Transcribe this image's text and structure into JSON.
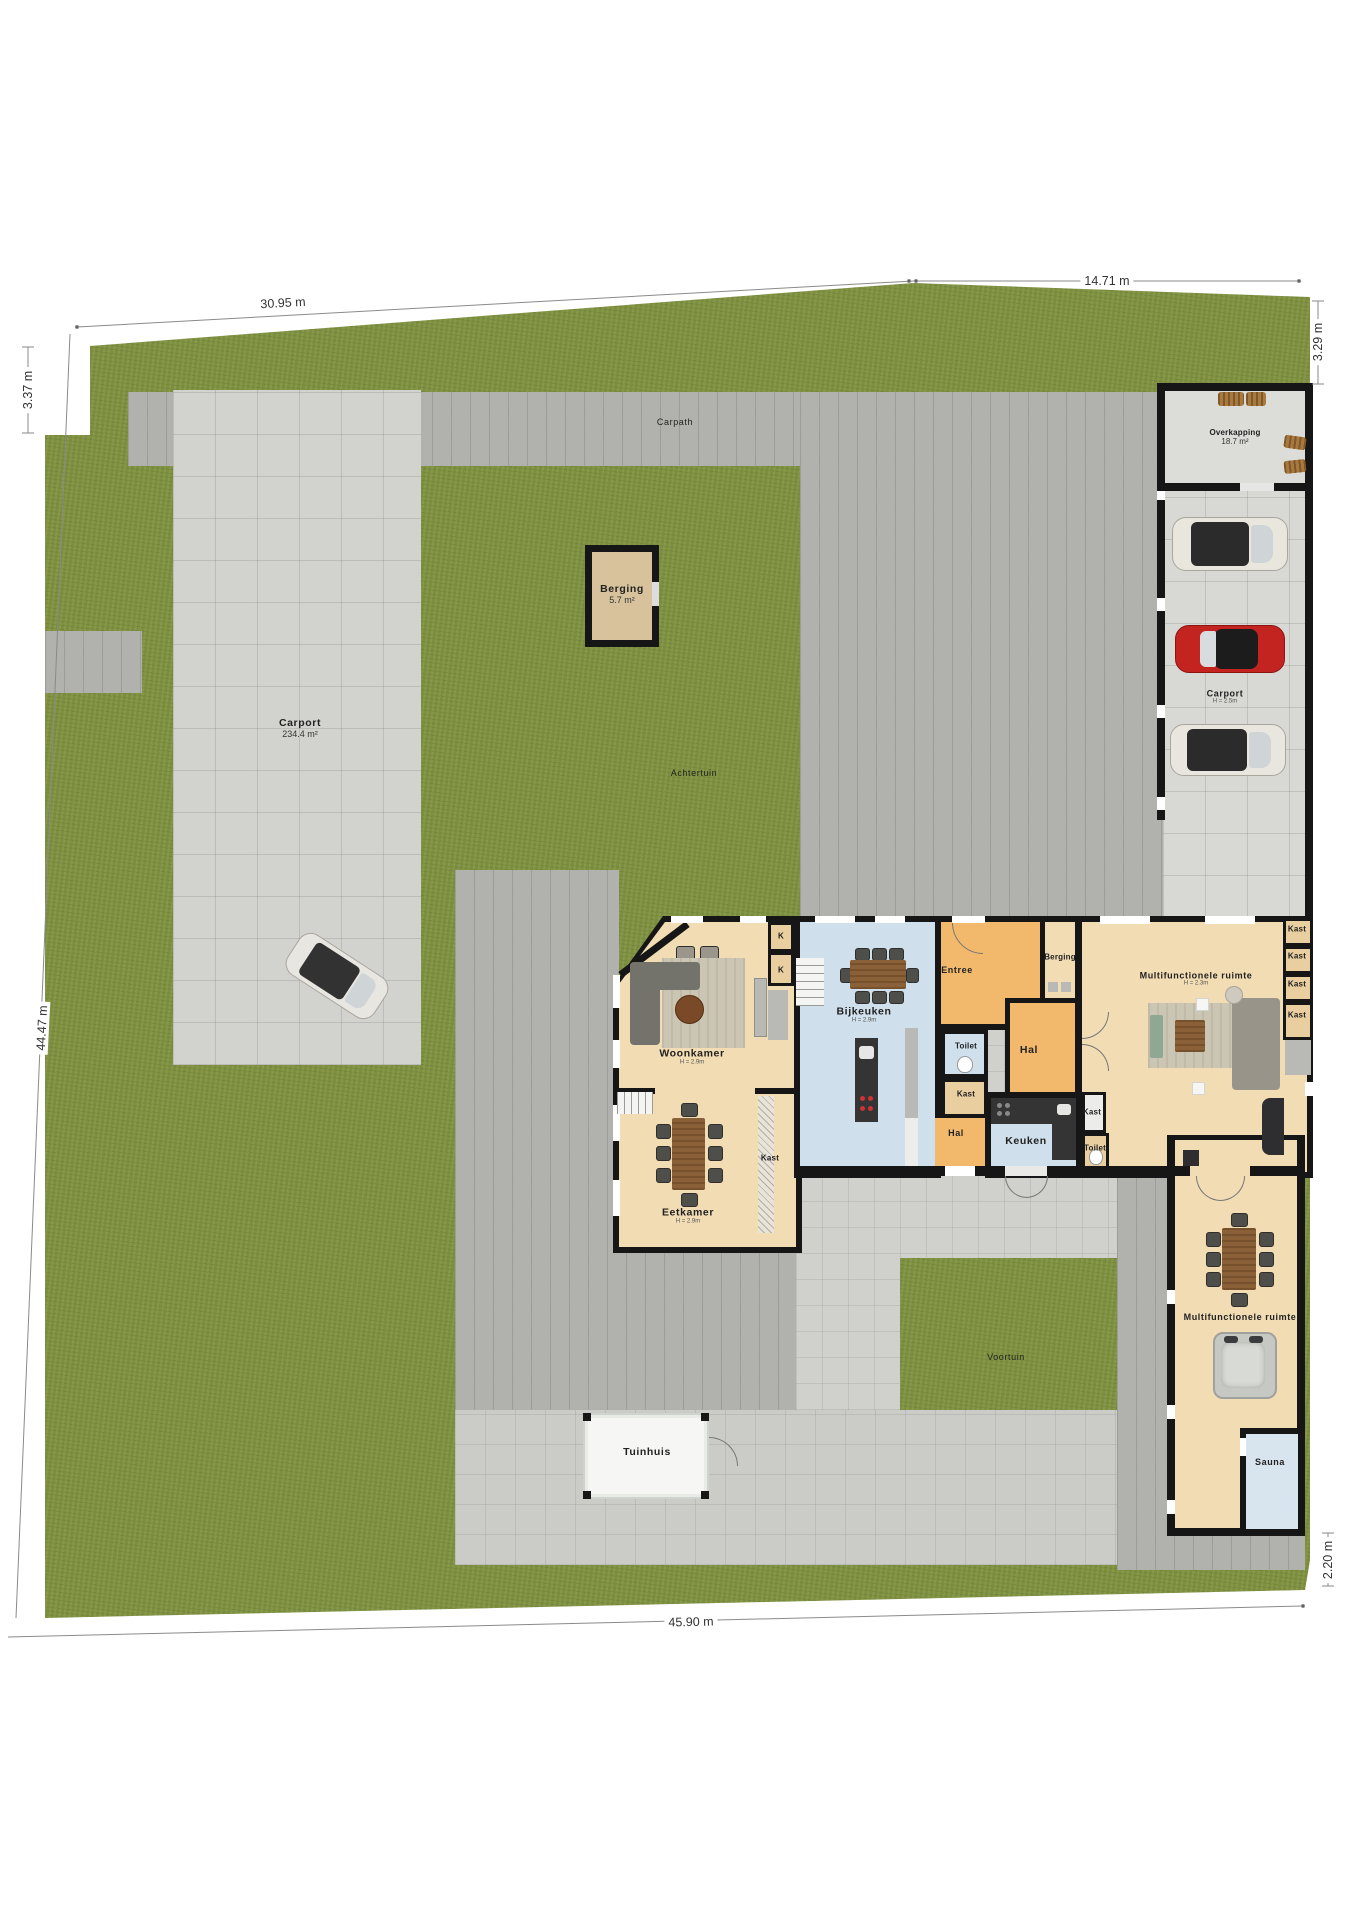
{
  "plan": {
    "dimensions": {
      "top_left": "30.95 m",
      "top_right": "14.71 m",
      "left_top": "3.37 m",
      "right_top": "3.29 m",
      "left_side": "44.47 m",
      "bottom": "45.90 m",
      "right_bottom": "2.20 m"
    },
    "outdoor": {
      "carpath_label": "Carpath",
      "carport_left_name": "Carport",
      "carport_left_area": "234.4 m²",
      "achtertuin_label": "Achtertuin",
      "voortuin_label": "Voortuin",
      "overkapping_name": "Overkapping",
      "overkapping_area": "18.7 m²",
      "carport_right_name": "Carport",
      "carport_right_height": "H = 2.5m",
      "berging_shed_name": "Berging",
      "berging_shed_area": "5.7 m²",
      "tuinhuis_label": "Tuinhuis"
    },
    "rooms": {
      "woonkamer_name": "Woonkamer",
      "woonkamer_height": "H = 2.9m",
      "bijkeuken_name": "Bijkeuken",
      "bijkeuken_height": "H = 2.9m",
      "eetkamer_name": "Eetkamer",
      "eetkamer_height": "H = 2.9m",
      "entree": "Entree",
      "berging": "Berging",
      "hal": "Hal",
      "toilet": "Toilet",
      "kast": "Kast",
      "kast_short": "K",
      "keuken": "Keuken",
      "multi1_name": "Multifunctionele ruimte",
      "multi1_height": "H = 2.3m",
      "multi2_name": "Multifunctionele ruimte",
      "sauna": "Sauna"
    },
    "colors": {
      "grass": "#7e9040",
      "cobble_paving": "#b1b2ae",
      "tile_paving": "#d2d3cf",
      "concrete": "#cbccc8",
      "floor_tan": "#f1dcb4",
      "floor_orange": "#f2b96d",
      "floor_blue": "#cfdfeb",
      "wall": "#161616",
      "car_red": "#c32420"
    }
  }
}
